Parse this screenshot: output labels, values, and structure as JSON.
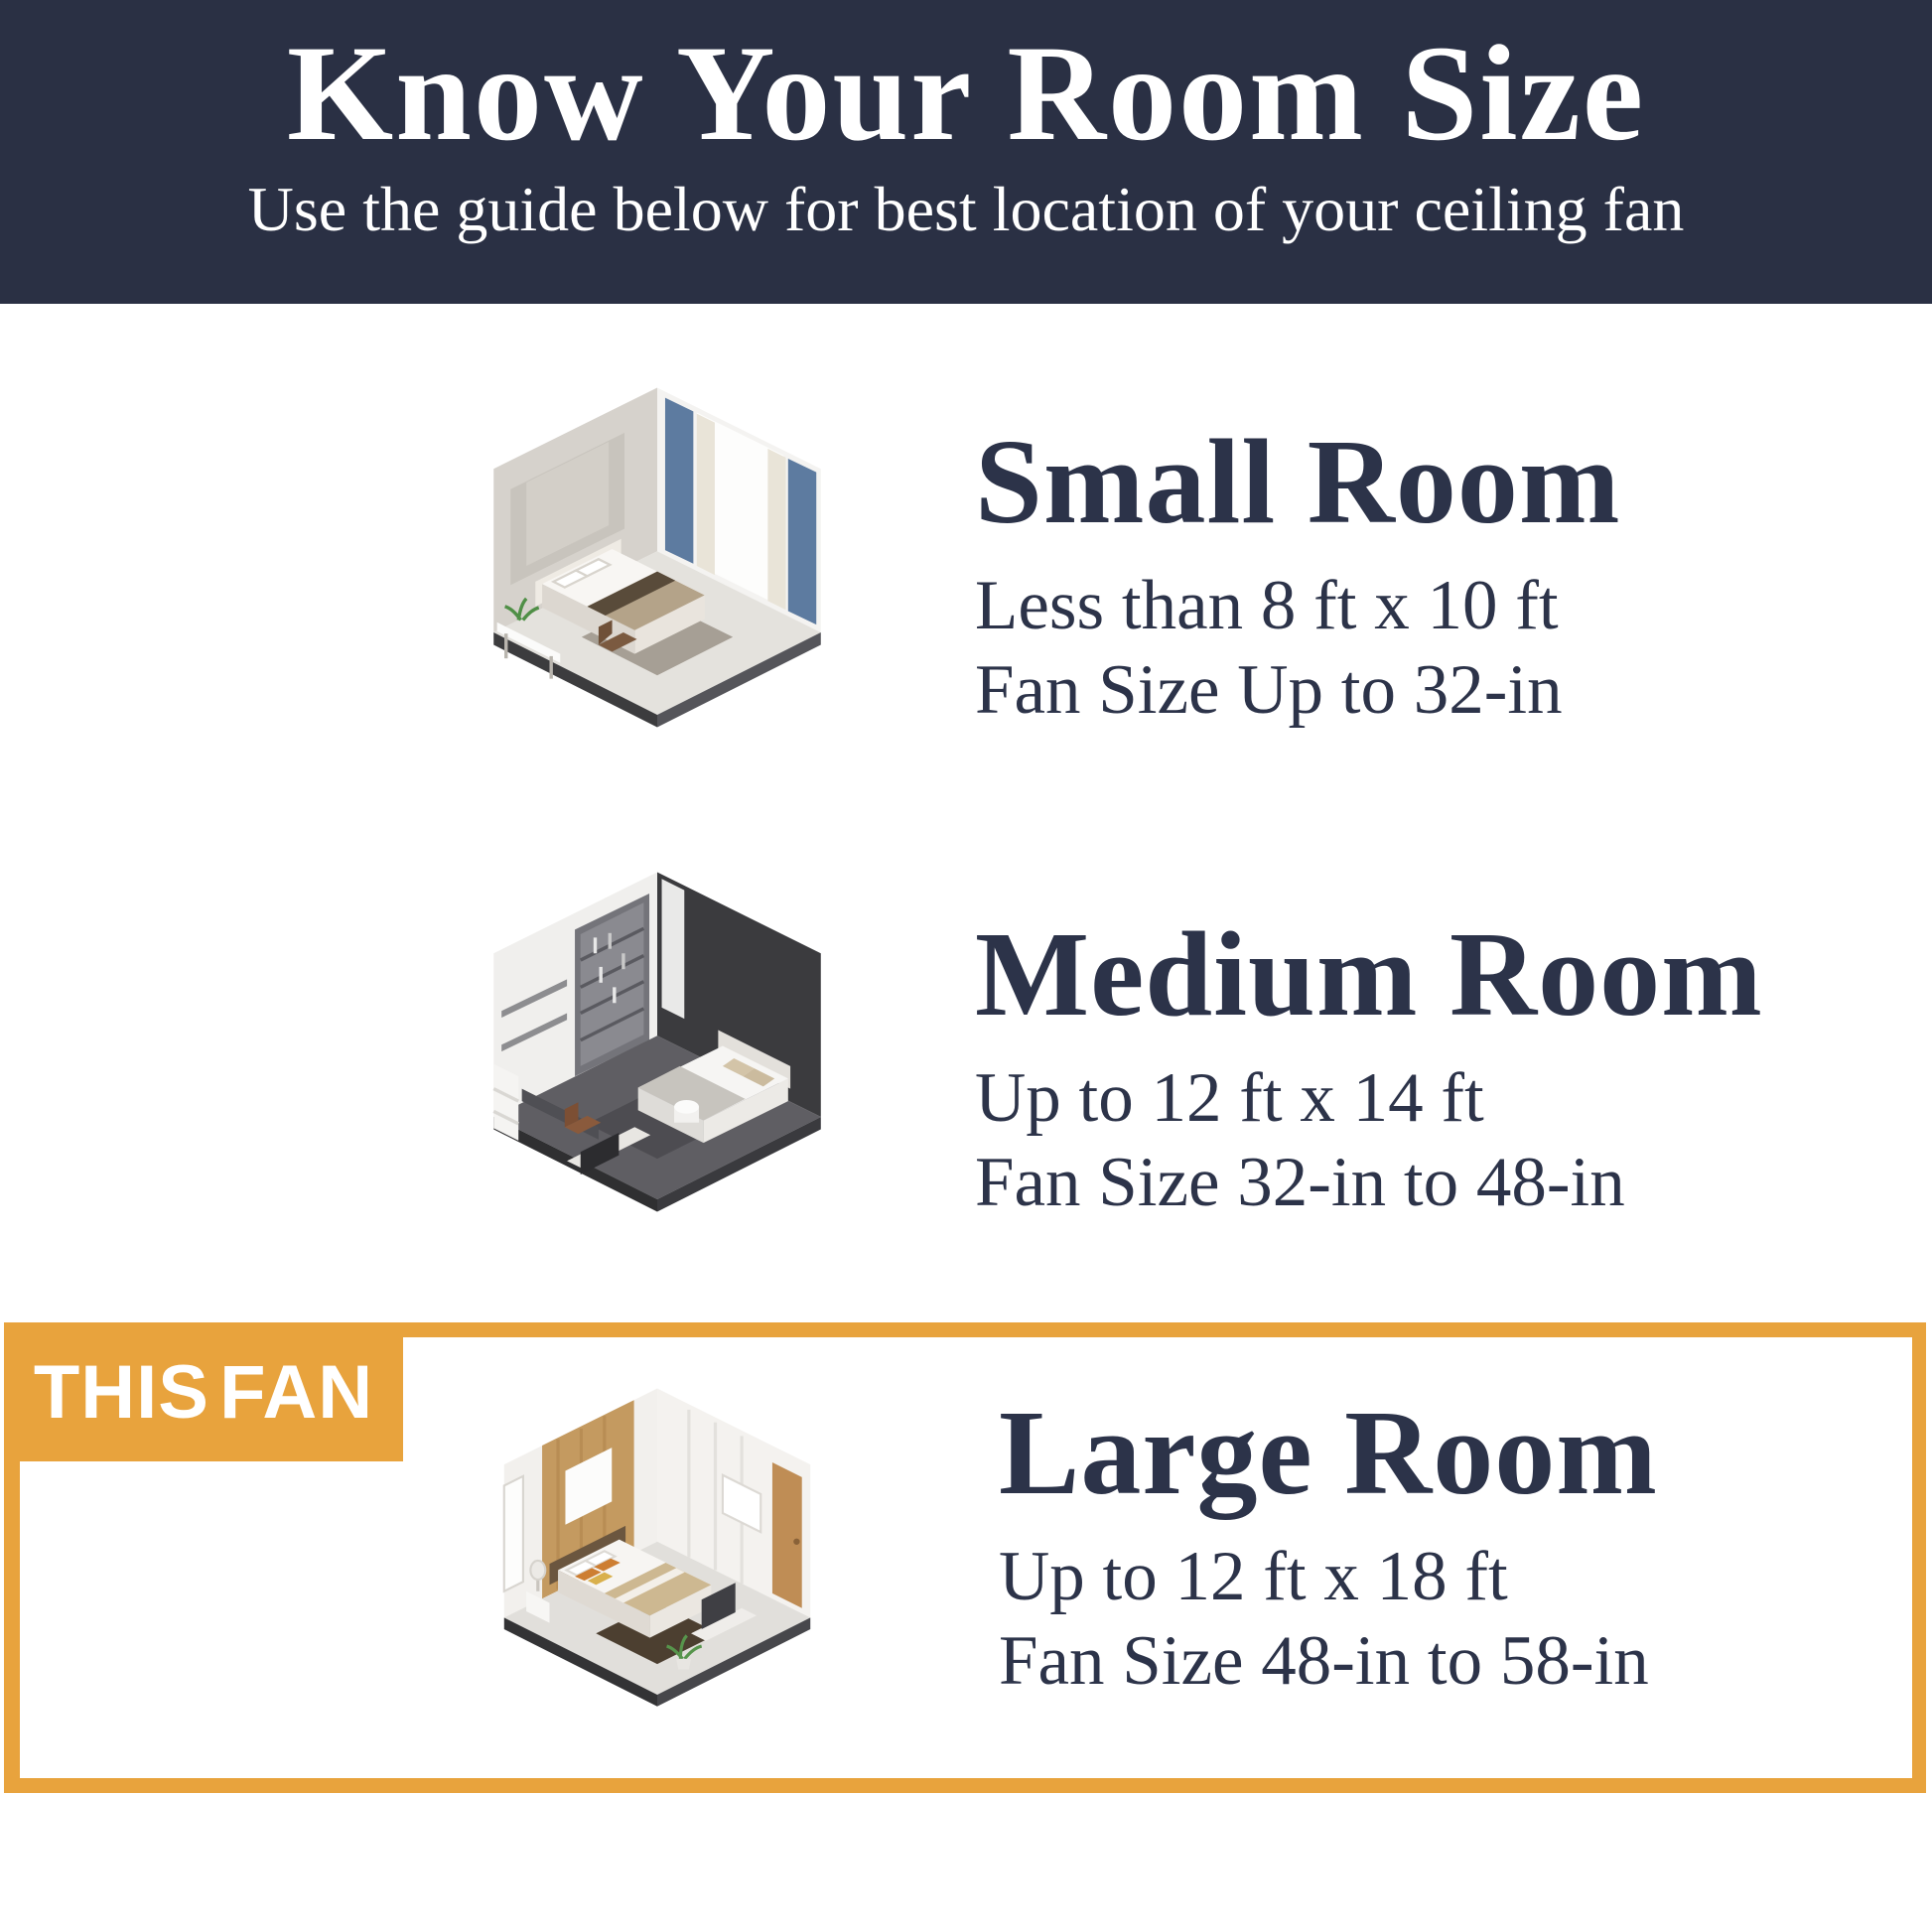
{
  "theme": {
    "header_bg": "#2a3044",
    "text_navy": "#2c3349",
    "accent_orange": "#e8a33d",
    "panel_white": "#ffffff"
  },
  "header": {
    "title": "Know Your Room Size",
    "subtitle": "Use the guide below for best location of your ceiling fan"
  },
  "highlight": {
    "badge_label": "THIS FAN"
  },
  "sections": [
    {
      "id": "small",
      "title": "Small Room",
      "dimensions": "Less than 8 ft x 10 ft",
      "fan_size": "Fan Size Up to 32-in",
      "illustration": "small-bedroom-isometric-render"
    },
    {
      "id": "medium",
      "title": "Medium Room",
      "dimensions": "Up to 12 ft x 14 ft",
      "fan_size": "Fan Size 32-in to 48-in",
      "illustration": "medium-bedroom-isometric-render"
    },
    {
      "id": "large",
      "title": "Large Room",
      "dimensions": "Up to 12 ft x 18 ft",
      "fan_size": "Fan Size 48-in to 58-in",
      "illustration": "large-bedroom-isometric-render",
      "highlighted": true
    }
  ]
}
